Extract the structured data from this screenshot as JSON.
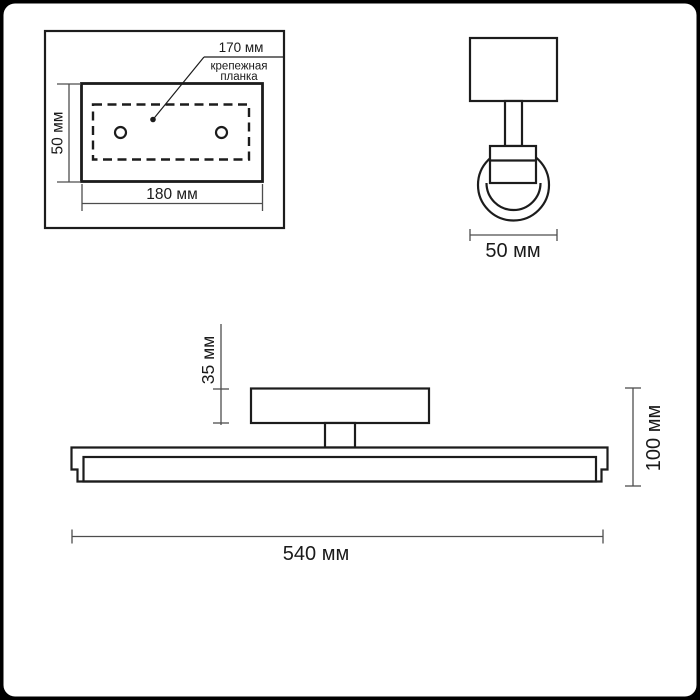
{
  "drawing": {
    "views": {
      "plate_detail": {
        "callout_dimension": "170 мм",
        "callout_line1": "крепежная",
        "callout_line2": "планка",
        "height_dimension": "50 мм",
        "width_dimension": "180 мм"
      },
      "side_view": {
        "width_dimension": "50 мм"
      },
      "front_view": {
        "canopy_height_dimension": "35 мм",
        "overall_height_dimension": "100 мм",
        "overall_width_dimension": "540 мм"
      }
    },
    "colors": {
      "outline": "#1c1c1c",
      "dimension_line": "#4d4d4d",
      "text": "#1a1a1a",
      "background": "#ffffff",
      "frame": "#000000"
    }
  }
}
